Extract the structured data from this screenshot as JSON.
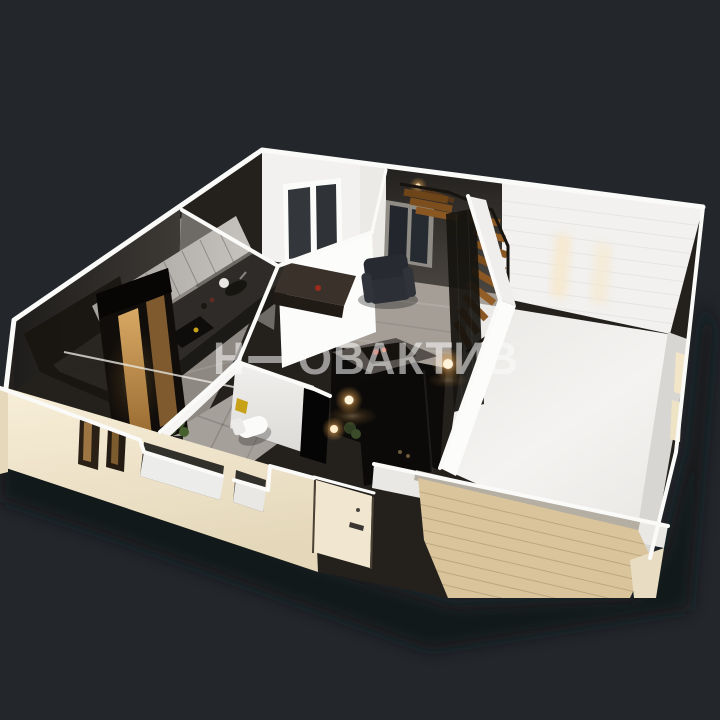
{
  "watermark": {
    "part1": "Н",
    "part2": "ОВАКТИВ",
    "full_text": "Н—ОВАКТИВ"
  },
  "colors": {
    "background": "#23262b",
    "shadow": "#101215",
    "watermark": "rgba(252,252,252,0.55)",
    "cream_wall": "#f3e9d1",
    "cream_dark": "#e6d9bb",
    "door": "#f1e7d0",
    "brick_tan": "#d9c49c",
    "brick_cap": "#b5aea3",
    "white_wall": "#f2f1ef",
    "bright_wall": "#fcfcfb",
    "dark_wall": "#35322f",
    "stair_wall": "#45413d",
    "kitchen_floor": "#8e8882",
    "living_floor": "#a49e97",
    "bath_floor": "#a6a09a",
    "white_floor": "#f0efed",
    "hall_floor": "#0d0b09",
    "counter": "#2e2b28",
    "cabinet": "#b9b6b2",
    "stair_wood": "#8a5722",
    "lamp_warm": "#ffd9a2",
    "sign_yellow": "#c7a118",
    "accent_red": "#992c1d",
    "plant_green": "#3c5229",
    "armchair": "#272b31",
    "ridge_white": "#fafaf8"
  }
}
